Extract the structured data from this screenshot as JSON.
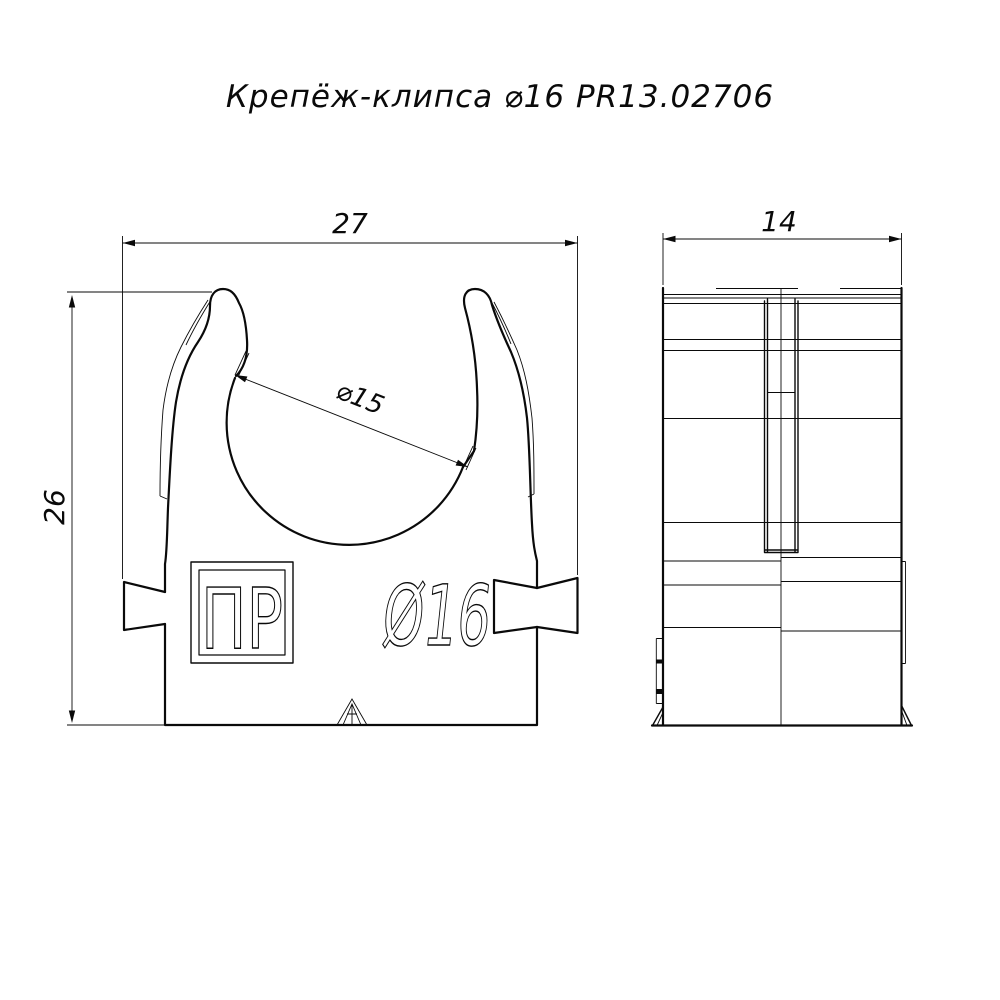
{
  "title": "Крепёж-клипса ⌀16 PR13.02706",
  "colors": {
    "line": "#0a0a0a",
    "background": "#ffffff"
  },
  "front_view": {
    "dim_width": "27",
    "dim_height": "26",
    "dim_inner_diameter": "⌀15",
    "marking": "Ø16",
    "logo": "ПР"
  },
  "side_view": {
    "dim_depth": "14"
  }
}
